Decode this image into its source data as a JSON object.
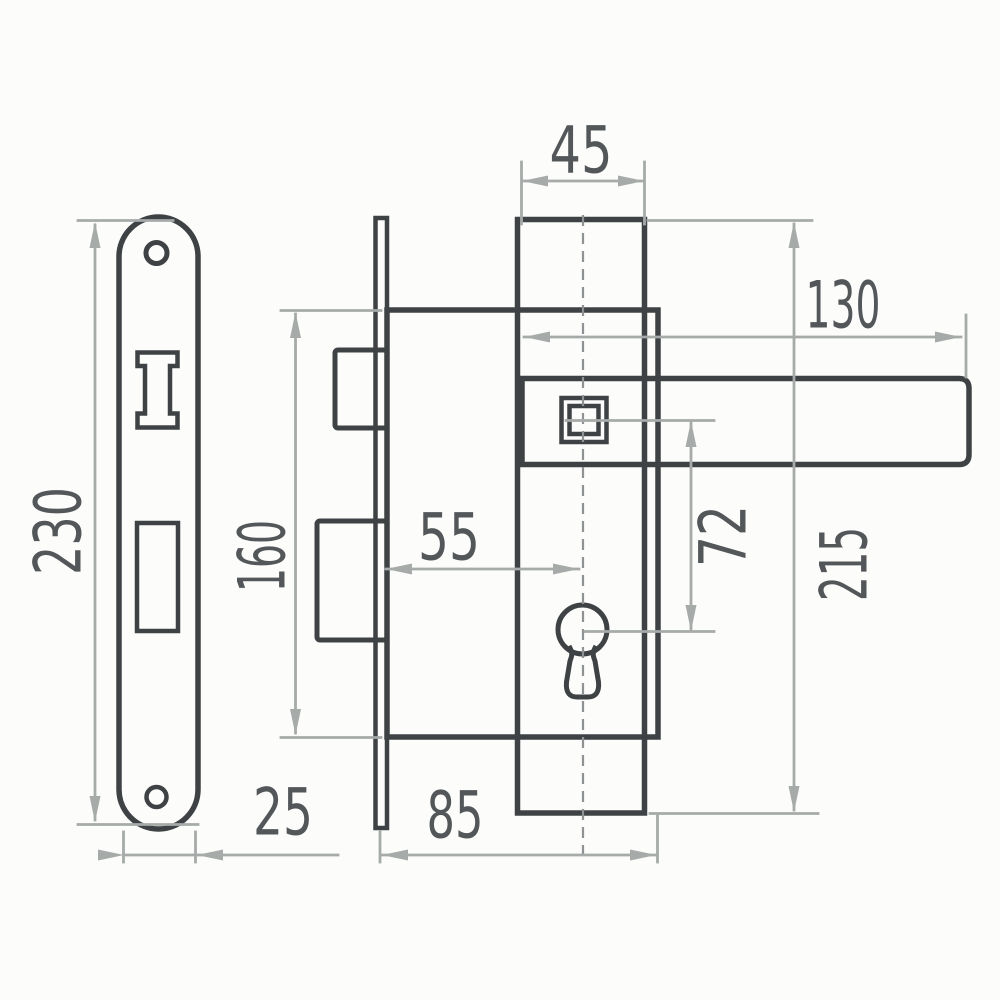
{
  "diagram": {
    "type": "technical-drawing",
    "subject": "mortise-lock-with-lever-handle-and-strike-plate",
    "dimensions": {
      "escutcheon_width": "45",
      "handle_length": "130",
      "strike_plate_height": "230",
      "lock_body_height": "160",
      "backset": "55",
      "spindle_to_cylinder": "72",
      "escutcheon_height": "215",
      "strike_plate_width": "25",
      "lock_body_width": "85"
    },
    "colors": {
      "outline": "#3f4244",
      "dimension": "#a6aaa9",
      "label": "#54575a",
      "background": "#fcfcfb"
    }
  }
}
